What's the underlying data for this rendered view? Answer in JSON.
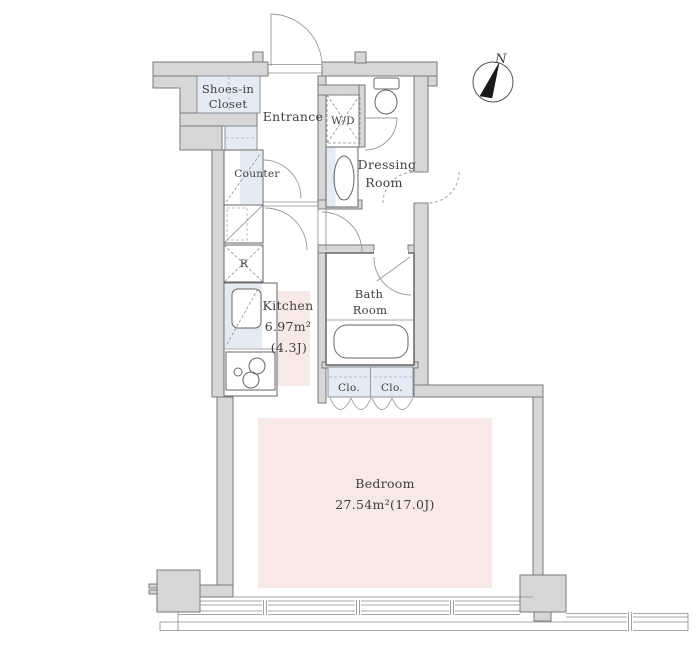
{
  "colors": {
    "wall_fill": "#d7d7d7",
    "wall_stroke": "#7a7a7a",
    "outline": "#666666",
    "fixture_blue": "#e4ebf4",
    "highlight_pink": "#f8e8e6",
    "door_arc": "#999999",
    "text": "#3f3f3f",
    "compass_needle": "#1a1a1a"
  },
  "compass": {
    "label": "N"
  },
  "rooms": {
    "shoes_closet": {
      "line1": "Shoes-in",
      "line2": "Closet"
    },
    "entrance": {
      "label": "Entrance"
    },
    "washer_dryer": {
      "label": "W/D"
    },
    "dressing_room": {
      "line1": "Dressing",
      "line2": "Room"
    },
    "counter": {
      "label": "Counter"
    },
    "refrigerator": {
      "label": "R"
    },
    "kitchen": {
      "label": "Kitchen",
      "area": "6.97m²",
      "tatami": "(4.3J)"
    },
    "bathroom": {
      "line1": "Bath",
      "line2": "Room"
    },
    "closet_left": {
      "label": "Clo."
    },
    "closet_right": {
      "label": "Clo."
    },
    "bedroom": {
      "label": "Bedroom",
      "area": "27.54m²(17.0J)"
    }
  }
}
